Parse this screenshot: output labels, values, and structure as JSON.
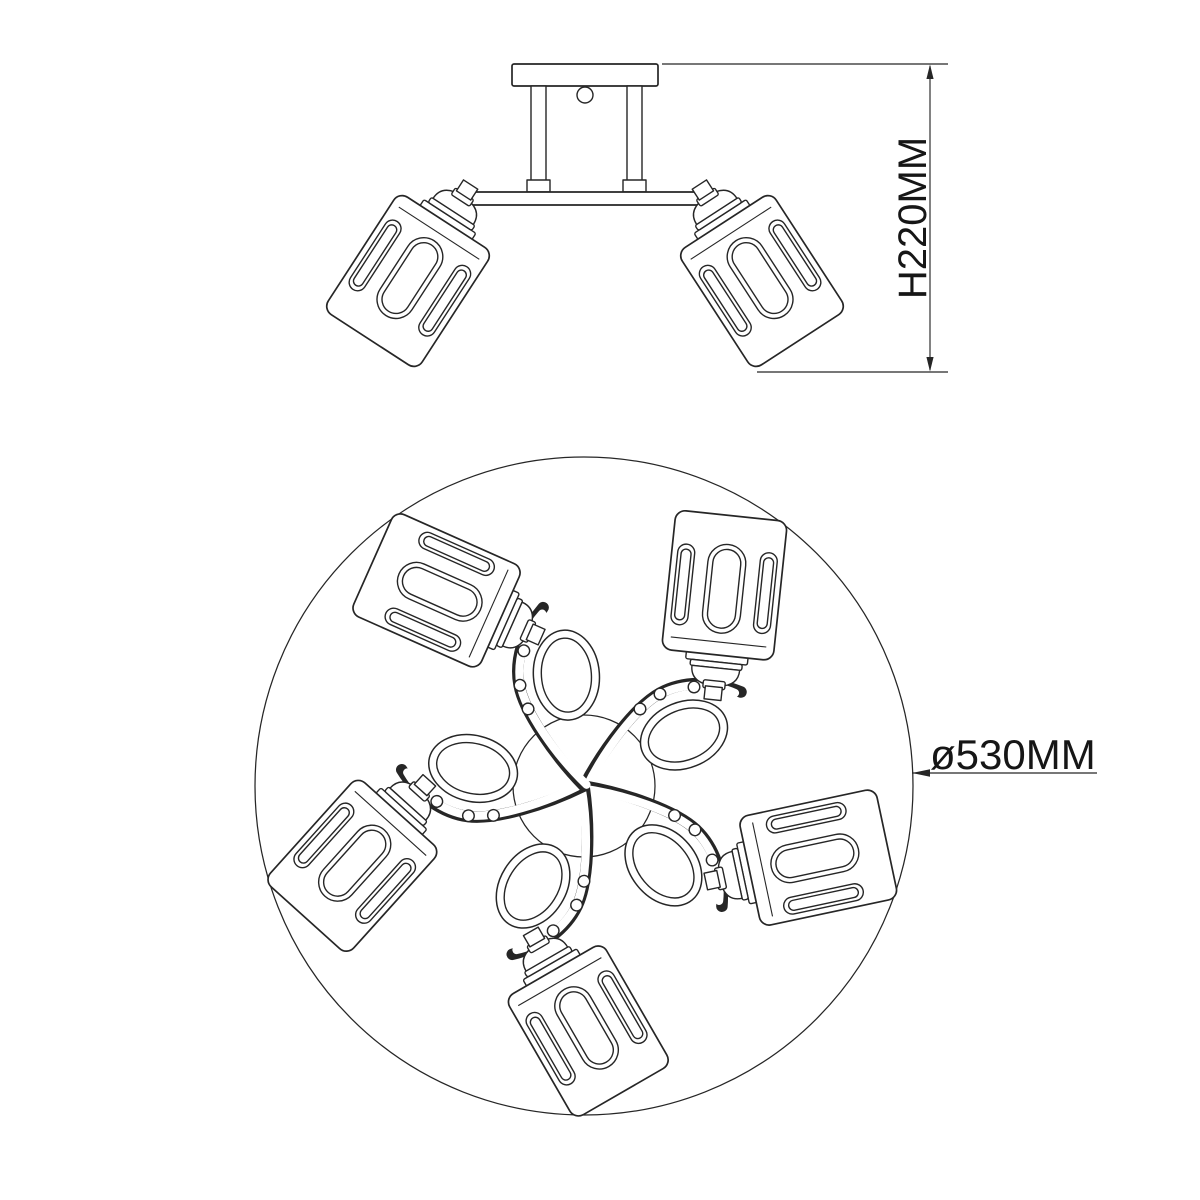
{
  "page": {
    "background_color": "#ffffff",
    "width_px": 1200,
    "height_px": 1200
  },
  "drawing": {
    "line_color": "#262626",
    "subject": "ceiling spotlight fixture technical drawing",
    "front_view": {
      "shade_count": 2,
      "height_dimension": {
        "label": "H220MM"
      }
    },
    "plan_view": {
      "shade_count": 5,
      "diameter_dimension": {
        "label": "ø530MM"
      }
    }
  }
}
